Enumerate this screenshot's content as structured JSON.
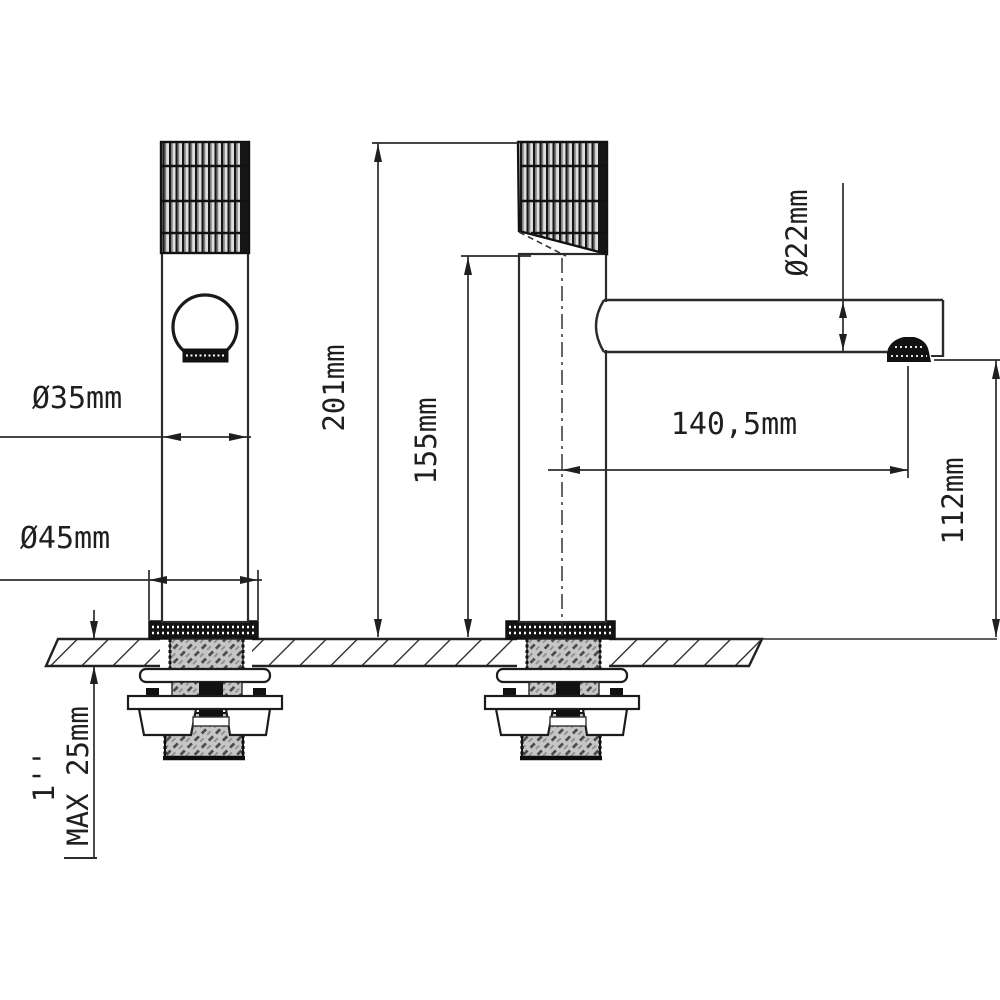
{
  "drawing": {
    "type": "technical-dimension-drawing",
    "subject": "basin faucet front and side views with mounting hardware",
    "dimensions": {
      "body_diameter": "Ø35mm",
      "base_diameter": "Ø45mm",
      "total_height": "201mm",
      "height_to_body_top": "155mm",
      "spout_diameter": "Ø22mm",
      "spout_reach": "140,5mm",
      "spout_outlet_height": "112mm",
      "max_counter_thickness": "MAX 25mm",
      "thread_size": "1''"
    },
    "colors": {
      "line": "#2b2b2b",
      "background": "#ffffff",
      "solid_fill": "#111111",
      "steel_fill": "#c4c4c4"
    }
  }
}
